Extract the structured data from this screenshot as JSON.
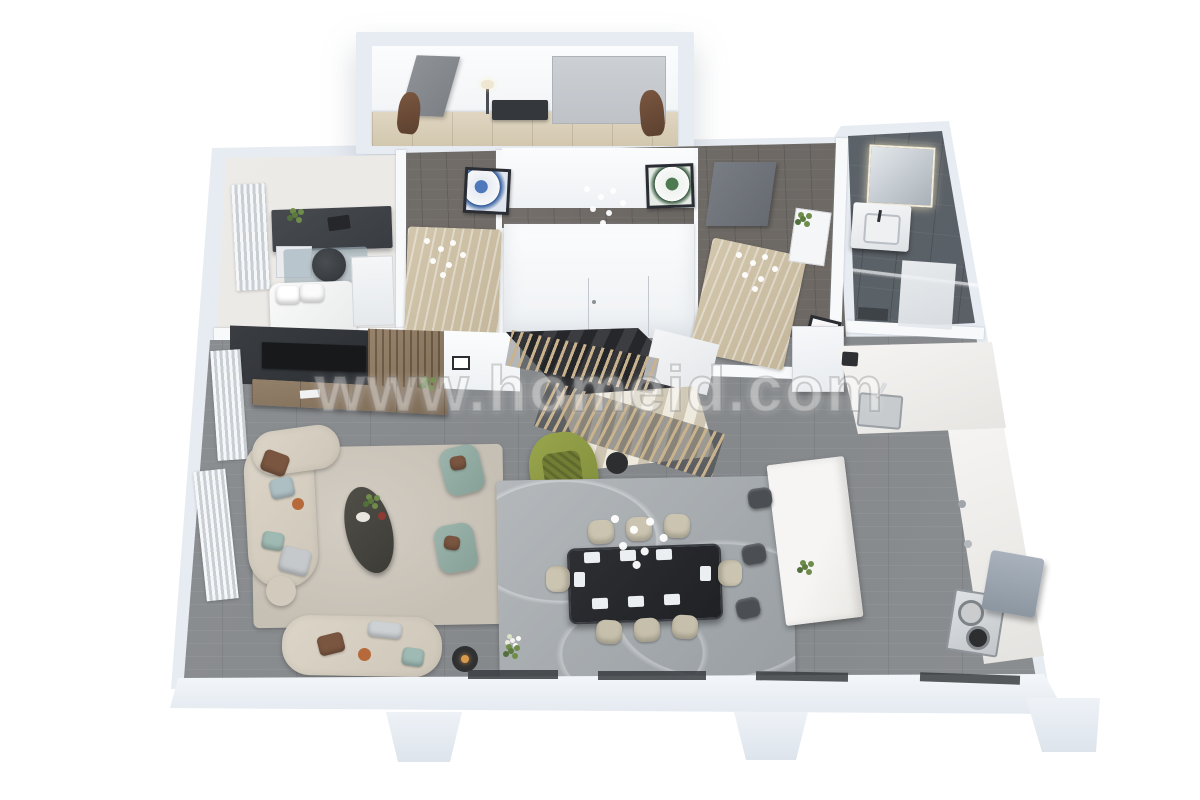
{
  "meta": {
    "title": "3D apartment floor plan render",
    "type": "3d-floor-plan",
    "view": "top-down isometric on white background"
  },
  "watermark": {
    "text": "www.homeid.com"
  },
  "palette": {
    "background": "#ffffff",
    "exterior_wall": "#e7ecf2",
    "interior_wall": "#f7f9fb",
    "wood_floor_gray": "#8a8d90",
    "wood_floor_dark": "#6f6a66",
    "bathroom_tile": "#5a6167",
    "tv_panel": "#33363a",
    "wood_slats": "#8d7a63",
    "living_rug": "#c9c3b9",
    "dining_rug": "#a7acaf",
    "dining_table": "#26282b",
    "chair_beige": "#cbc4b0",
    "armchair_teal": "#93aca4",
    "accent_chair_green": "#8f9c44",
    "island_marble": "#f1f0ee",
    "stool_dark": "#4b4f53",
    "closet_wood": "#d8cdb6",
    "statue_brown": "#6d4b36"
  },
  "rooms": [
    {
      "name": "entry-foyer",
      "items": [
        "entry-door",
        "wardrobe-panel",
        "console-table",
        "table-lamp",
        "statue-left",
        "statue-right",
        "closet-row"
      ]
    },
    {
      "name": "home-office-bedroom",
      "items": [
        "desk",
        "office-chair",
        "laptop",
        "desk-plant",
        "drawer-unit",
        "bed",
        "wardrobe",
        "striped-curtain",
        "blue-rug"
      ]
    },
    {
      "name": "bedroom-1",
      "items": [
        "patterned-bed-rug",
        "chandelier"
      ]
    },
    {
      "name": "hallway",
      "items": [
        "art-frame-blue",
        "art-frame-green",
        "chandelier",
        "stairwell-enclosure",
        "hall-cabinet"
      ]
    },
    {
      "name": "bedroom-2",
      "items": [
        "gray-door",
        "patterned-rug",
        "chandelier",
        "shelf-unit",
        "plant",
        "art-frame-small"
      ]
    },
    {
      "name": "bathroom",
      "items": [
        "lit-mirror",
        "vanity-sink",
        "glass-partition",
        "shower-panel",
        "bath-mat"
      ]
    },
    {
      "name": "living-room",
      "items": [
        "tv-accent-panel",
        "tv",
        "slat-wall",
        "media-console",
        "console-plant",
        "corner-sofa",
        "sofa",
        "pillows",
        "coffee-table",
        "pouf",
        "armchair-teal-1",
        "armchair-teal-2",
        "floor-lamp",
        "area-rug",
        "curtains"
      ]
    },
    {
      "name": "stairs",
      "items": [
        "upper-dark-flight",
        "white-landing",
        "lower-light-flight",
        "wood-slat-railing",
        "green-accent-armchair",
        "side-table"
      ]
    },
    {
      "name": "dining-area",
      "items": [
        "dining-table",
        "dining-chairs-8",
        "place-settings",
        "chandelier",
        "swirl-rug",
        "flower-plant"
      ]
    },
    {
      "name": "kitchen",
      "items": [
        "wall-counter",
        "coffee-machine",
        "sink",
        "faucet",
        "right-counter",
        "cooktop",
        "pot-1",
        "pot-2",
        "marble-island",
        "island-plant",
        "bar-stool-1",
        "bar-stool-2",
        "bar-stool-3",
        "ac-unit"
      ]
    }
  ]
}
